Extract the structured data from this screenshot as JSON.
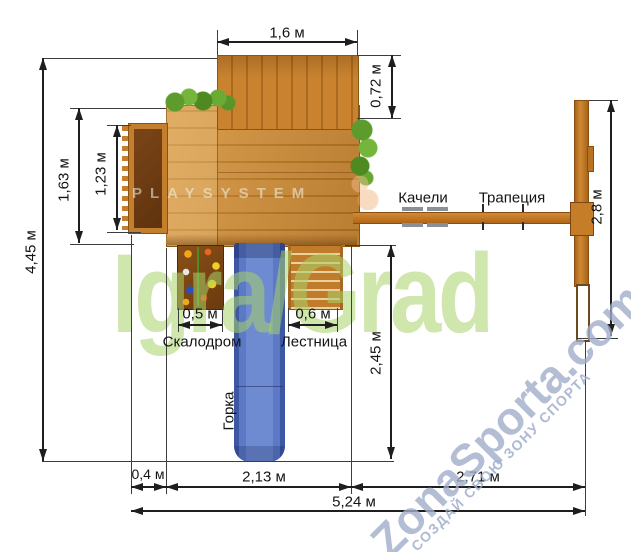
{
  "title": "Playground set top-view dimensional drawing",
  "dimensions": {
    "top_width": "1,6 м",
    "canopy_depth": "0,72 м",
    "total_depth": "4,45 м",
    "platform_depth": "1,63 м",
    "balcony_depth": "1,23 м",
    "swing_frame_depth": "2,8 м",
    "slide_run": "2,45 м",
    "balcony_offset": "0,4 м",
    "platform_width": "2,13 м",
    "swing_span": "2,71 м",
    "total_width": "5,24 м",
    "climbing_wall_width": "0,5 м",
    "ladder_width": "0,6 м"
  },
  "labels": {
    "swings": "Качели",
    "trapeze": "Трапеция",
    "climbing_wall": "Скалодром",
    "ladder": "Лестница",
    "slide": "Горка"
  },
  "watermarks": {
    "playsystem": "PLAYSYSTEM",
    "brand": "Igra/Grad",
    "site": "ZonaSporta.com",
    "site_slogan": "СОЗДАЙ СВОЮ ЗОНУ СПОРТА"
  },
  "colors": {
    "wood": "#c9832f",
    "wood_dark": "#a96a1d",
    "wood_deep": "#7a4517",
    "slide_blue": "#5b79c4",
    "foliage_green": "#5d9c2c",
    "brand_green": "#a8d26a",
    "watermark_blue": "#a0aeca",
    "line": "#1e1e1e"
  }
}
